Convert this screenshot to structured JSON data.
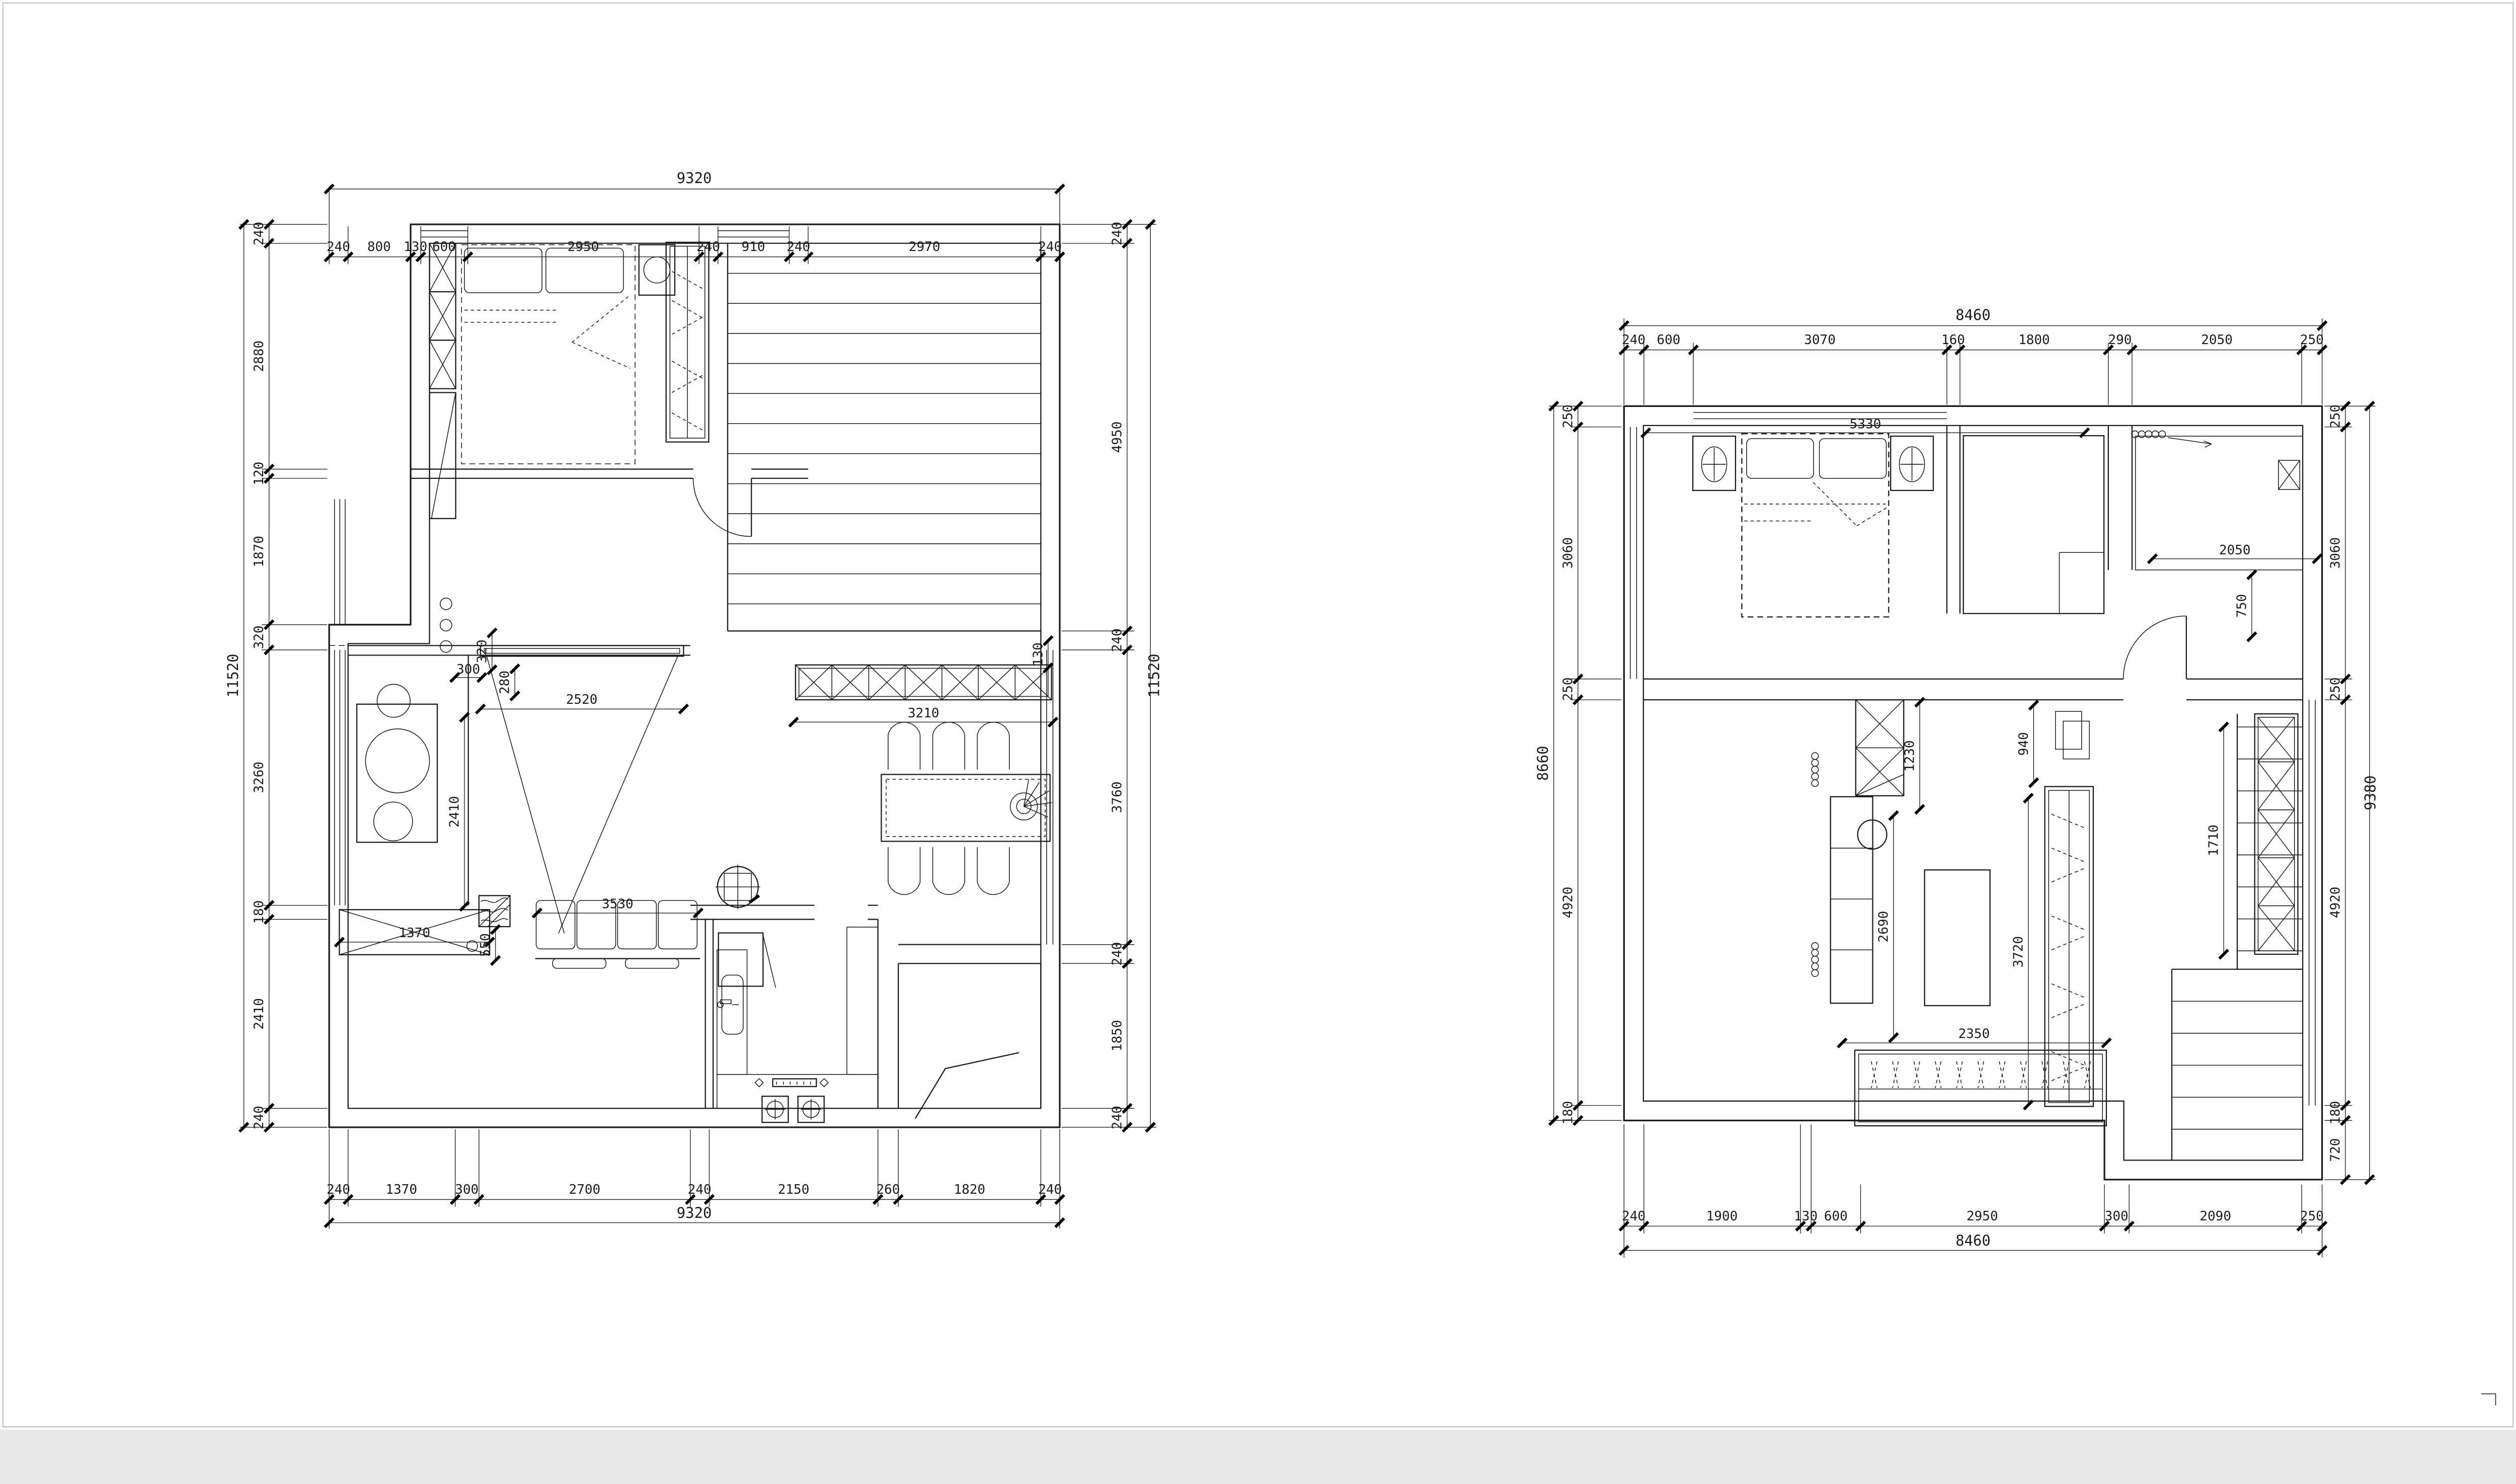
{
  "sheet": {
    "background": "#ffffff",
    "line_color": "#1c1c1c"
  },
  "plan1": {
    "top_total": "9320",
    "top": [
      "240",
      "800",
      "130",
      "600",
      "2950",
      "240",
      "910",
      "240",
      "2970",
      "240"
    ],
    "bottom": [
      "240",
      "1370",
      "300",
      "2700",
      "240",
      "2150",
      "260",
      "1820",
      "240"
    ],
    "bottom_total": "9320",
    "left_total": "11520",
    "left": [
      "240",
      "2880",
      "120",
      "1870",
      "320",
      "3260",
      "180",
      "2410",
      "240"
    ],
    "right": [
      "240",
      "4950",
      "240",
      "3760",
      "240",
      "1850",
      "240"
    ],
    "right_total": "11520",
    "inner": {
      "d320": "320",
      "d300": "300",
      "d280": "280",
      "d2520": "2520",
      "d130": "130",
      "d2410": "2410",
      "d1370": "1370",
      "d3530": "3530",
      "d3210": "3210",
      "d550": "550"
    }
  },
  "plan2": {
    "top_total": "8460",
    "top": [
      "240",
      "600",
      "3070",
      "160",
      "1800",
      "290",
      "2050",
      "250"
    ],
    "bottom": [
      "240",
      "1900",
      "130",
      "600",
      "2950",
      "300",
      "2090",
      "250"
    ],
    "bottom_total": "8460",
    "left_total": "8660",
    "left": [
      "250",
      "3060",
      "250",
      "4920",
      "180"
    ],
    "right": [
      "250",
      "3060",
      "250",
      "4920",
      "180",
      "720"
    ],
    "right_total": "9380",
    "inner": {
      "d5330": "5330",
      "d2050": "2050",
      "d750": "750",
      "d1710": "1710",
      "d1230": "1230",
      "d940": "940",
      "d2690": "2690",
      "d3720": "3720",
      "d2350": "2350"
    }
  }
}
